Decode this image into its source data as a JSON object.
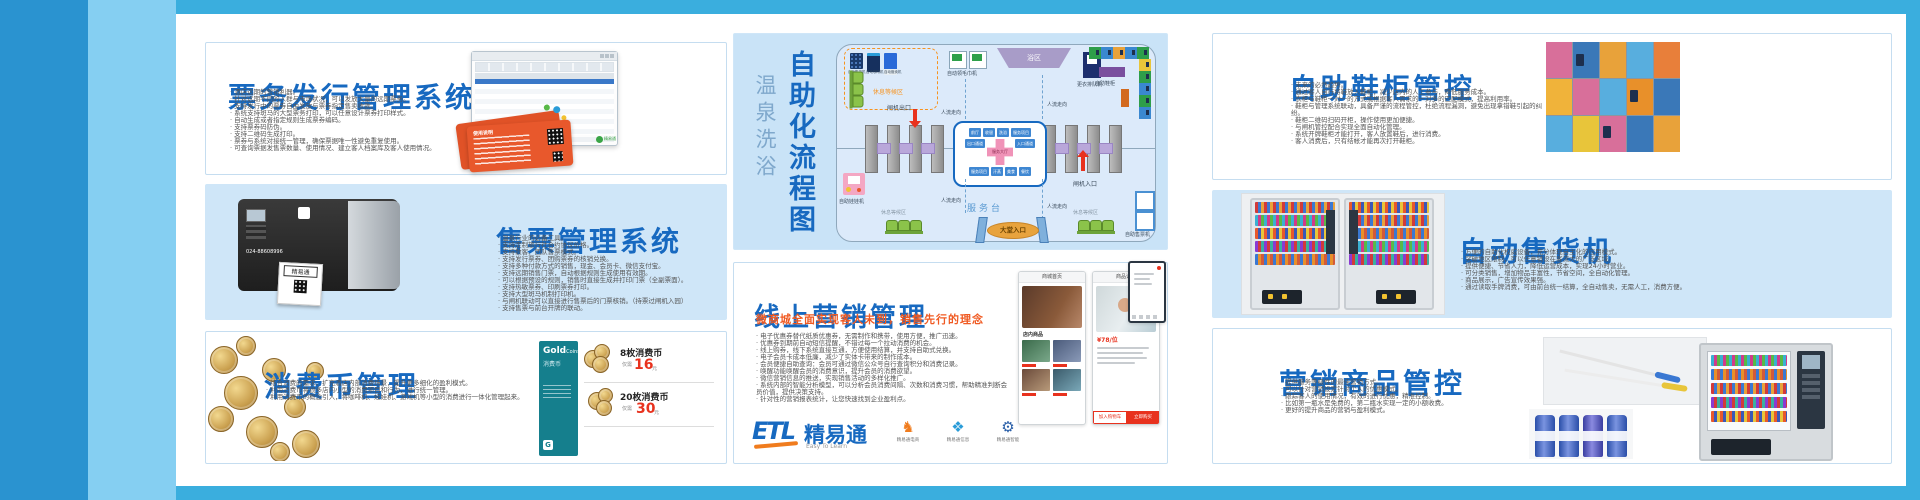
{
  "colors": {
    "frame": "#3aaede",
    "band_dark": "#2a93d0",
    "band_light": "#85cff2",
    "title_blue": "#1769c0",
    "accent_orange": "#f05a22",
    "panel_blue": "#cfe6f8",
    "price_red": "#e8321e"
  },
  "ticket_issue": {
    "title": "票务发行管理系统",
    "bullets": [
      "酒店远期的营销利器。",
      "针对远期不同的人群与市场状况，可以发放大量的远期票务。",
      "支持发行中的票券自由发放与票券指定售卖收款。",
      "系统支持斑马的大型票务打印，可以任意设计票券打印样式。",
      "自动生成或者指定规则生成票券编码。",
      "支持票券码防伪。",
      "支持二维码生成打印。",
      "票券与系统对接统一管理，确保票据唯一性避免重复使用。",
      "可查询票据发售票数量、使用情况、建立客人档案库及客人使用情况。"
    ],
    "card_title": "使用说明",
    "screenshot_logo": "精易通"
  },
  "ticket_sale": {
    "title": "售票管理系统",
    "bullets": [
      "温泉行业的必备工具。",
      "支持定制旅行社合约协议价格。",
      "支持散客、团队售票模式。",
      "支持发行票券、团购票券的核销兑换。",
      "支持多种付款方式的销售，现金、会员卡、微信支付宝。",
      "支持远期销售门票，自动根据规则生成使用有效期。",
      "可以根据预设的规则，销售时直接生成并打印门票（全副票面）。",
      "支持热敏票券、印刷票券打印。",
      "支持大型斑马机制打印机。",
      "与闸机联动可以直接进行售票后的门票核销。（持票过闸机入园）",
      "支持售票与前台开牌的联动。"
    ],
    "printer_label": "精易通",
    "printer_phone": "024-88608996"
  },
  "coin": {
    "title": "消费币管理",
    "bullets": [
      "结合消费的需求，扩充酒店内部消费场景，提升更多细化的盈利模式。",
      "利用消费币将很多店内小型的消费项目和行为，进行统一管理。",
      "利用消费币的概念引入，将咖啡机、娃娃机、游戏机等小型的消费进行一体化管理起来。"
    ],
    "card": {
      "g": "Gold",
      "c": "Coins",
      "sub": "消费币"
    },
    "offers": [
      {
        "qty": "8枚消费币",
        "need": "仅需",
        "price": "16",
        "unit": "元"
      },
      {
        "qty": "20枚消费币",
        "need": "仅需",
        "price": "30",
        "unit": "元"
      }
    ]
  },
  "flow": {
    "title_light": "温泉洗浴",
    "title_bold": "自助化流程图",
    "rest_area": "休息等候区",
    "machines_top": [
      "自动售货机",
      "自动咖啡机",
      "自动贩卖机"
    ],
    "towel": "自动领毛巾机",
    "bath": "浴区",
    "queue": "更衣排队机",
    "shoe_cab": "自助鞋柜",
    "gate_out": "闸机出口",
    "gate_in": "闸机入口",
    "flow_dir": "人流走向",
    "service_desk": "服务台",
    "lobby": "大堂入口",
    "ticket_machine": "自助售票机",
    "claw": "自助娃娃机",
    "hub": {
      "center": "服务大厅",
      "top": [
        "前厅",
        "收银",
        "洗浴",
        "服务项目"
      ],
      "mid": [
        "出口通道",
        "入口通道"
      ],
      "bottom": [
        "服务项目",
        "汗蒸",
        "美食",
        "餐饮"
      ]
    }
  },
  "marketing": {
    "title": "线上营销管理",
    "subtitle": "微商城全面实现客人未到，销售先行的理念",
    "bullets": [
      "电子优惠券替代纸质优惠券，无需制作和携带，使用方便，推广迅速。",
      "优惠券到期前自动短信提醒，不错过每一个拉动消费的机会。",
      "线上购券，线下系统直接互通，方便使用结算，并支持自助式兑换。",
      "电子会员卡成本低廉，减少了实体卡带来的制作成本。",
      "会员便捷自助查询：会员可通过微信公众号自行查询积分和消费记录。",
      "唤醒功能唤醒会员的消费意识，提升会员的消费欲望。",
      "微信营销信息的推送，实现销售活动的多样化推广。",
      "系统内部的智能分析模型，可以分析会员消费间隔、次数和消费习惯，帮助精准判断会员价值，提供决策支持。",
      "针对性的营销报表统计，让您快速找到企业盈利点。"
    ],
    "logo": {
      "etl": "ETL",
      "brand": "精易通",
      "slogan": "Easy To Learn",
      "products": [
        "精易通电商",
        "精易通信息",
        "精易通智能"
      ]
    },
    "phones": {
      "home_title": "商城首页",
      "detail_title": "商品详情",
      "shop_label": "店内商品",
      "price": "¥78/位",
      "btn_cart": "加入购物车",
      "btn_buy": "立即购买"
    }
  },
  "shoe": {
    "title": "自助鞋柜管控",
    "bullets": [
      "未来的必然趋势。",
      "通过客人自行将鞋放入鞋柜，减少店内的人工参与，降低服务成本。",
      "衣柜与鞋柜一对一的方式或根据客人需求的一对多的匹配模式，提高利用率。",
      "鞋柜与管理系统联动，具备严谨的流程管控，杜绝流程漏洞，避免出现拿错鞋引起的纠纷。",
      "鞋柜二维码扫码开柜，操作使用更加便捷。",
      "与闸机管控配合实现全面自动化管理。",
      "系统开牌鞋柜才能打开，客人放置鞋后，进行消费。",
      "客人消费后，只有结帐才能再次打开鞋柜。"
    ]
  },
  "vending": {
    "title": "自动售货机",
    "bullets": [
      "方便的自助化权威设备，充分体现自主化的应用模式。",
      "突破地区限制，可以任意铺设在客流大的广泛区域。",
      "提供便捷、节省人力，降低运营成本，实现24小时营业。",
      "可分类销售，增加物品丰富性，节省空间，全自动化管理。",
      "商品展示，广告宣传效果强。",
      "通过读取手牌消费，可由前台统一结算，全自动售卖，无需人工，消费方便。"
    ]
  },
  "goods": {
    "title": "营销商品管控",
    "bullets": [
      "提供服务等级性的最佳营销方式。",
      "可以针对营销设定针对个人的优惠模式。",
      "跟踪客人的使用情况，有效的进行优惠，精准控制。",
      "比如第一瓶水是免费的，第二瓶水实现一定的小额收费。",
      "更好的提升商品的营销与盈利模式。"
    ]
  }
}
